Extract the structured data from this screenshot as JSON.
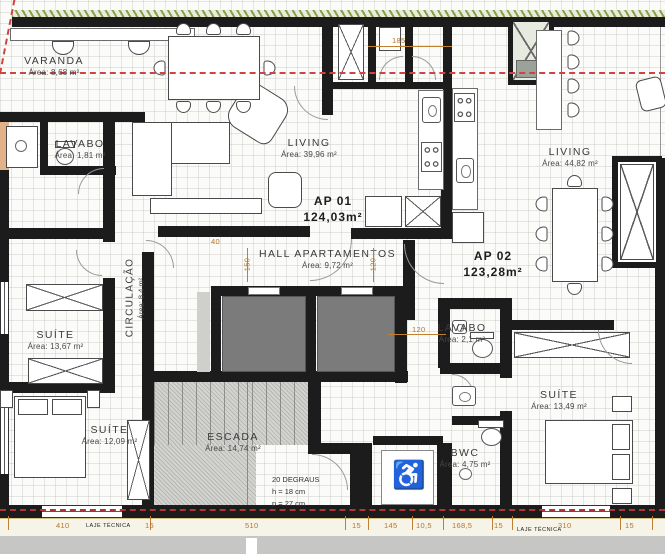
{
  "apartments": [
    {
      "name": "AP 01",
      "area": "124,03m²"
    },
    {
      "name": "AP 02",
      "area": "123,28m²"
    }
  ],
  "rooms": {
    "varanda": {
      "name": "VARANDA",
      "area": "Área: 8,68 m²"
    },
    "lavabo1": {
      "name": "LAVABO",
      "area": "Área: 1,81 m²"
    },
    "living1": {
      "name": "LIVING",
      "area": "Área: 39,96 m²"
    },
    "living2": {
      "name": "LIVING",
      "area": "Área: 44,82 m²"
    },
    "hall": {
      "name": "HALL APARTAMENTOS",
      "area": "Área: 9,72 m²"
    },
    "circulacao": {
      "name": "CIRCULAÇÃO",
      "area": "Área: 8,4 m²"
    },
    "suite1": {
      "name": "SUÍTE",
      "area": "Área: 13,67 m²"
    },
    "suite2": {
      "name": "SUÍTE",
      "area": "Área: 12,09 m²"
    },
    "escada": {
      "name": "ESCADA",
      "area": "Área: 14,74 m²"
    },
    "lavabo2": {
      "name": "LAVABO",
      "area": "Área: 2,1 m²"
    },
    "suite3": {
      "name": "SUÍTE",
      "area": "Área: 13,49 m²"
    },
    "bwc": {
      "name": "BWC",
      "area": "Área: 4,75 m²"
    }
  },
  "stair_note": {
    "line1": "20 DEGRAUS",
    "line2": "h = 18 cm",
    "line3": "p = 27 cm"
  },
  "dimensions": {
    "d185": "185",
    "d40": "40",
    "d150": "150",
    "d120v": "120",
    "d120h": "120",
    "b410": "410",
    "b15a": "15",
    "b510": "510",
    "b15b": "15",
    "b145": "145",
    "b105": "10,5",
    "b1685": "168,5",
    "b15c": "15",
    "b310": "310",
    "b15d": "15",
    "laje1": "LAJE TÉCNICA",
    "laje2": "LAJE TÉCNICA"
  },
  "icons": {
    "wheelchair": "♿"
  },
  "colors": {
    "wall": "#1c1c1c",
    "dimension": "#b5762a",
    "centerline": "#cf4343",
    "elevator_shaft": "#7b7b7b",
    "stair_fill": "#d3d3d0",
    "hatch_green": "#87a04a",
    "accessible_accent": "#b3c118"
  }
}
